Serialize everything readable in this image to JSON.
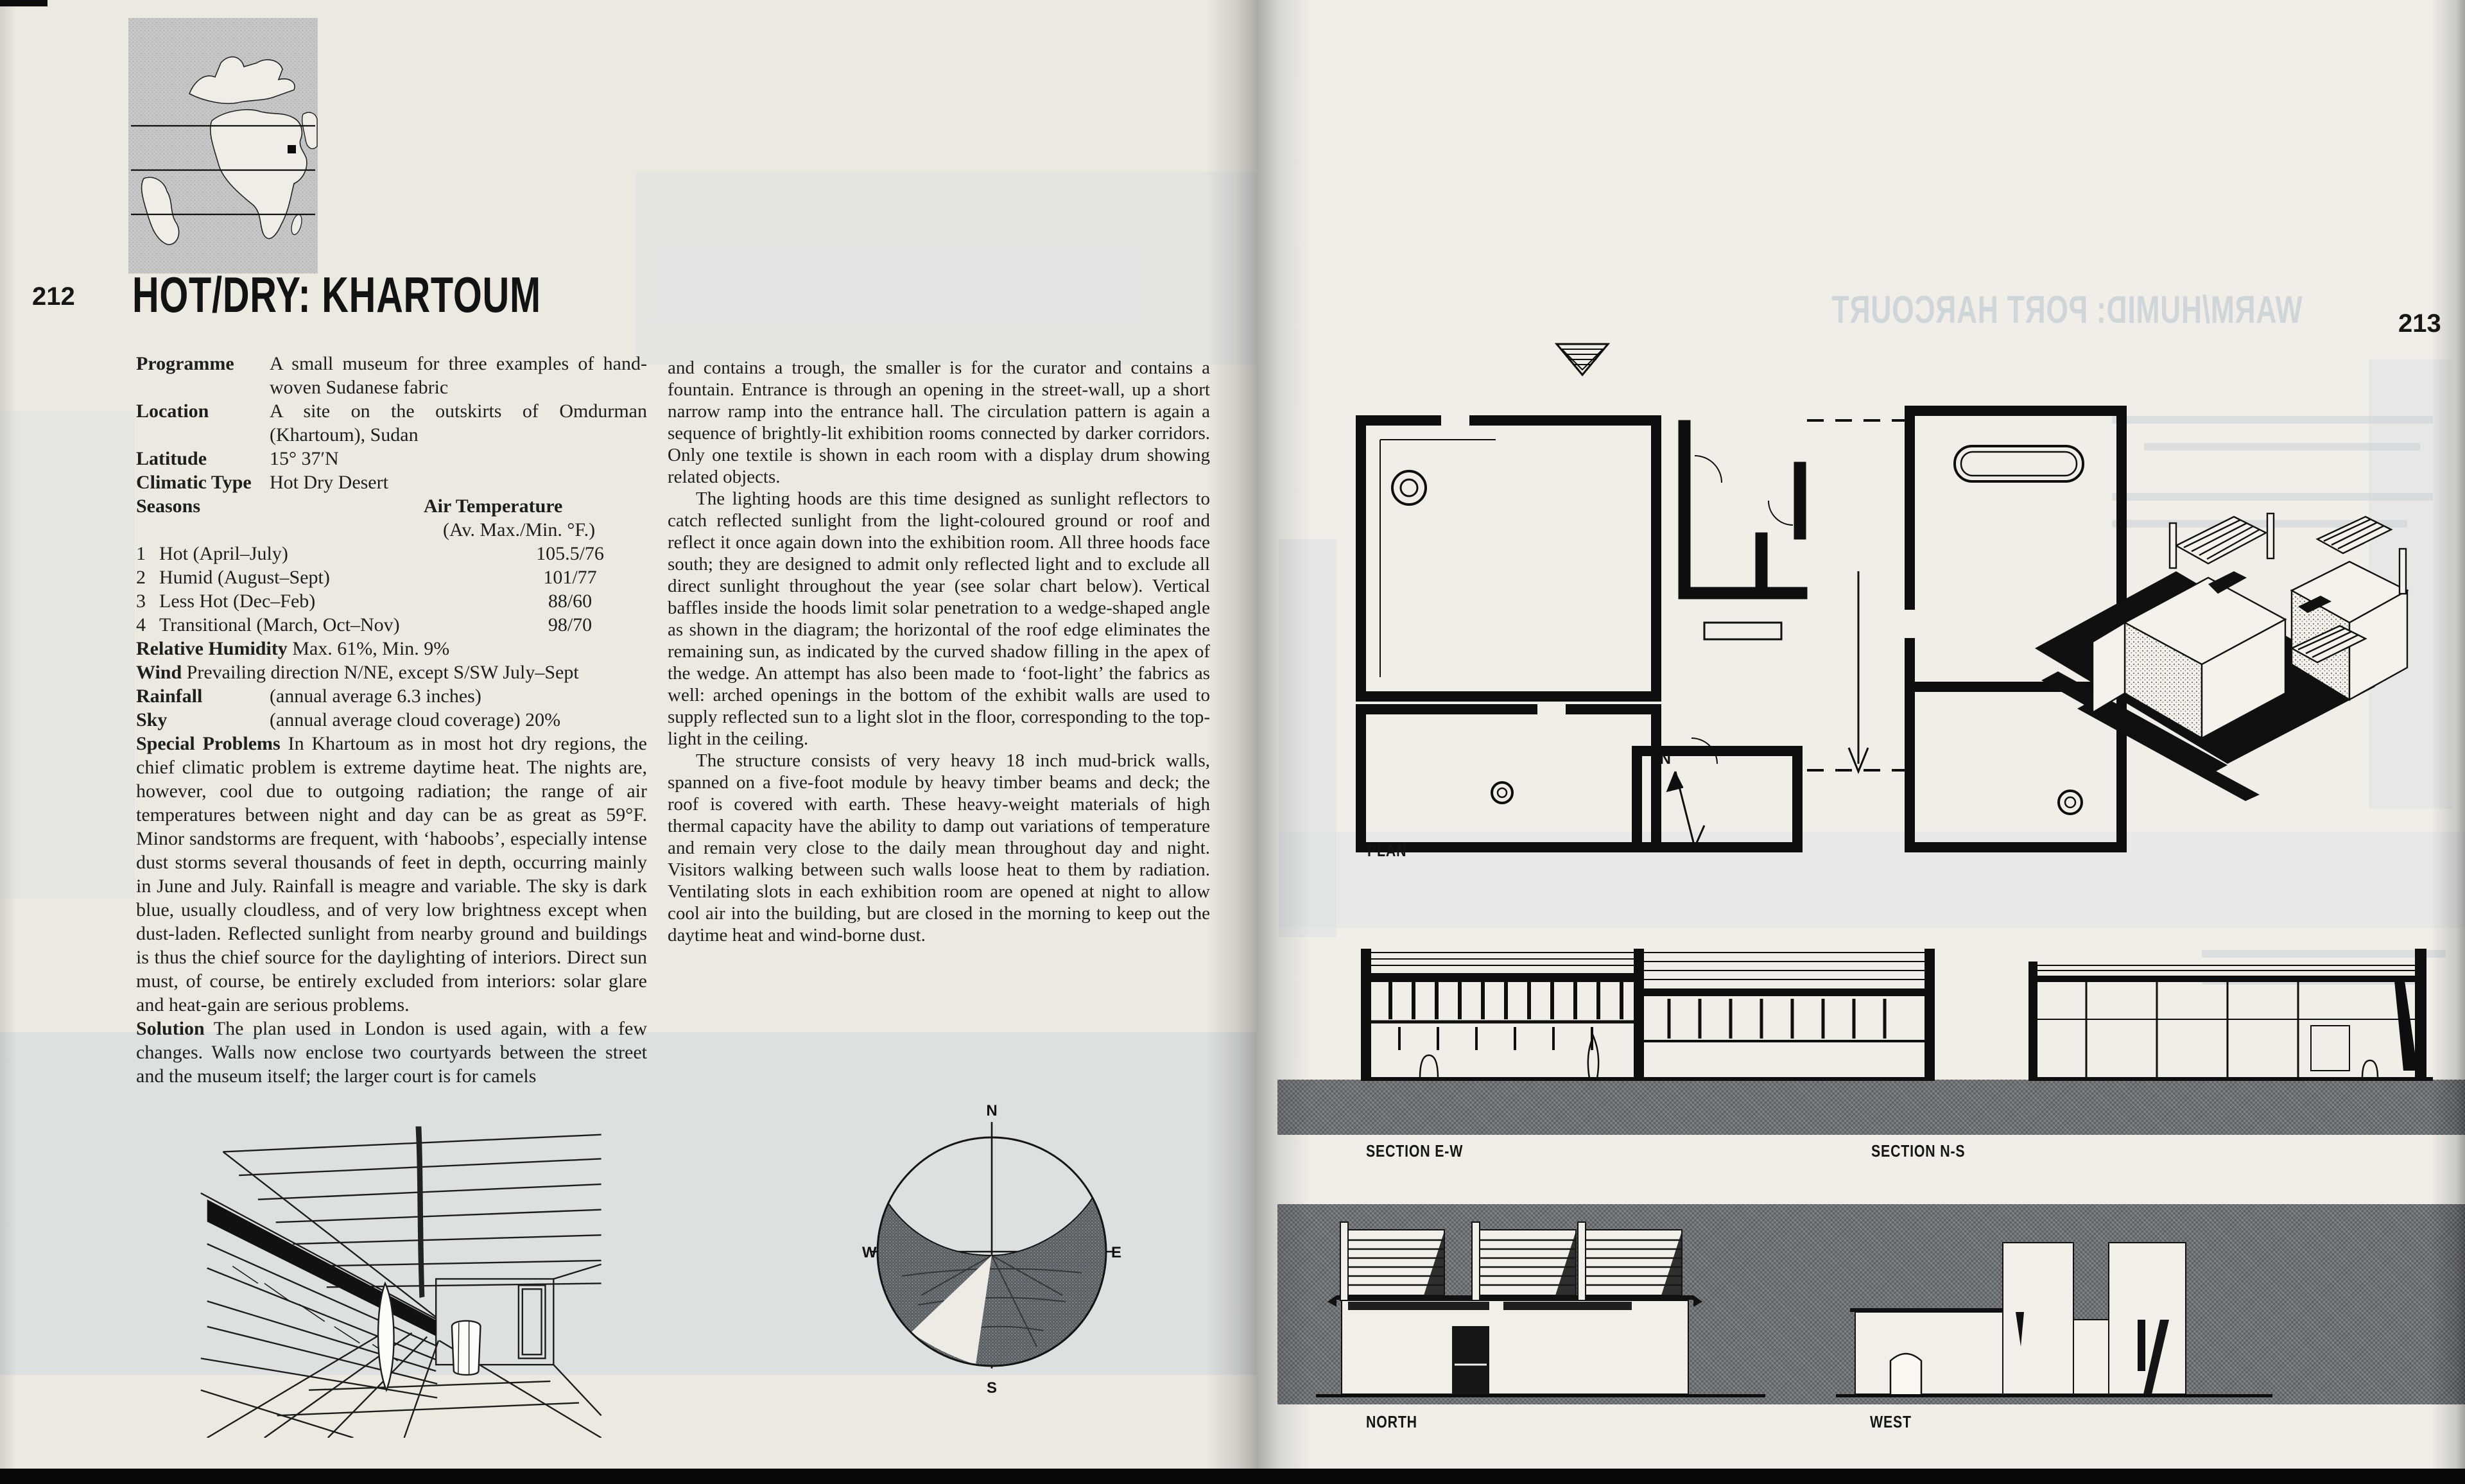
{
  "left_page": {
    "page_number": "212",
    "title": "HOT/DRY: KHARTOUM",
    "facts": [
      {
        "label": "Programme",
        "value": "A small museum for three examples of hand-woven Sudanese fabric"
      },
      {
        "label": "Location",
        "value": "A site on the outskirts of Omdurman (Khartoum), Sudan"
      },
      {
        "label": "Latitude",
        "value": "15° 37′N"
      },
      {
        "label": "Climatic Type",
        "value": "Hot Dry Desert"
      }
    ],
    "seasons": {
      "label": "Seasons",
      "air_temp_header": "Air Temperature",
      "air_temp_sub": "(Av. Max./Min. °F.)",
      "rows": [
        {
          "num": "1",
          "name": "Hot (April–July)",
          "value": "105.5/76"
        },
        {
          "num": "2",
          "name": "Humid (August–Sept)",
          "value": "101/77"
        },
        {
          "num": "3",
          "name": "Less Hot (Dec–Feb)",
          "value": "88/60"
        },
        {
          "num": "4",
          "name": "Transitional (March, Oct–Nov)",
          "value": "98/70"
        }
      ]
    },
    "humidity_label": "Relative Humidity",
    "humidity_value": " Max. 61%, Min. 9%",
    "wind_label": "Wind",
    "wind_value": " Prevailing direction N/NE, except S/SW July–Sept",
    "rainfall_label": "Rainfall",
    "rainfall_value": "(annual average 6.3 inches)",
    "sky_label": "Sky",
    "sky_value": "(annual average cloud coverage) 20%",
    "special_problems_label": "Special Problems",
    "special_problems_text": "  In Khartoum as in most hot dry regions, the chief climatic problem is extreme daytime heat. The nights are, however, cool due to outgoing radiation; the range of air temperatures between night and day can be as great as 59°F. Minor sandstorms are frequent, with ‘haboobs’, especially intense dust storms several thousands of feet in depth, occurring mainly in June and July. Rainfall is meagre and variable. The sky is dark blue, usually cloudless, and of very low brightness except when dust-laden. Reflected sunlight from nearby ground and buildings is thus the chief source for the daylighting of interiors. Direct sun must, of course, be entirely excluded from interiors: solar glare and heat-gain are serious problems.",
    "solution_label": "Solution",
    "solution_text": " The plan used in London is used again, with a few changes. Walls now enclose two courtyards between the street and the museum itself; the larger court is for camels"
  },
  "middle_column": {
    "para1": "and contains a trough, the smaller is for the curator and contains a fountain. Entrance is through an opening in the street-wall, up a short narrow ramp into the entrance hall. The circulation pattern is again a sequence of brightly-lit exhibition rooms connected by darker corridors. Only one textile is shown in each room with a display drum showing related objects.",
    "para2": "The lighting hoods are this time designed as sunlight reflectors to catch reflected sunlight from the light-coloured ground or roof and reflect it once again down into the exhibition room. All three hoods face south; they are designed to admit only reflected light and to exclude all direct sunlight throughout the year (see solar chart below). Vertical baffles inside the hoods limit solar penetration to a wedge-shaped angle as shown in the diagram; the horizontal of the roof edge eliminates the remaining sun, as indicated by the curved shadow filling in the apex of the wedge. An attempt has also been made to ‘foot-light’ the fabrics as well: arched openings in the bottom of the exhibit walls are used to supply reflected sun to a light slot in the floor, corresponding to the top-light in the ceiling.",
    "para3": "The structure consists of very heavy 18 inch mud-brick walls, spanned on a five-foot module by heavy timber beams and deck; the roof is covered with earth. These heavy-weight materials of high thermal capacity have the ability to damp out variations of temperature and remain very close to the daily mean throughout day and night. Visitors walking between such walls loose heat to them by radiation. Ventilating slots in each exhibition room are opened at night to allow cool air into the building, but are closed in the morning to keep out the daytime heat and wind-borne dust."
  },
  "right_page": {
    "page_number": "213",
    "showthrough_title": "WARM/HUMID: PORT HARCOURT",
    "labels": {
      "plan": "PLAN",
      "section_ew": "SECTION E-W",
      "section_ns": "SECTION N-S",
      "north": "NORTH",
      "west": "WEST",
      "north_arrow": "N"
    }
  },
  "solar_chart": {
    "n": "N",
    "s": "S",
    "e": "E",
    "w": "W"
  },
  "colors": {
    "left_page_bg": "#ece9e1",
    "right_page_bg": "#f0eee7",
    "ink": "#1e1e1e",
    "halftone_gray": "#6d7175",
    "map_gray": "#c3c5c4",
    "showthrough_blue": "#c9d2d8"
  }
}
